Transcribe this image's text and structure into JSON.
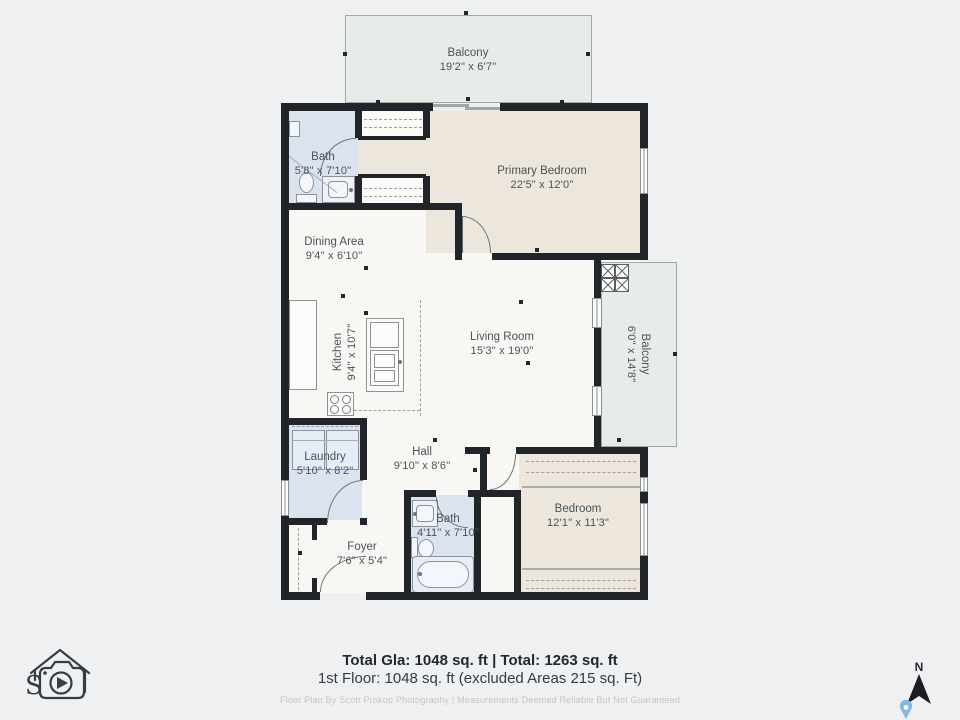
{
  "plan": {
    "rooms": {
      "balcony_top": {
        "name": "Balcony",
        "dims": "19'2\" x 6'7\""
      },
      "bath_upper": {
        "name": "Bath",
        "dims": "5'8\" x 7'10\""
      },
      "primary_bedroom": {
        "name": "Primary Bedroom",
        "dims": "22'5\" x 12'0\""
      },
      "dining": {
        "name": "Dining Area",
        "dims": "9'4\" x 6'10\""
      },
      "kitchen": {
        "name": "Kitchen",
        "dims": "9'4\" x 10'7\""
      },
      "living": {
        "name": "Living Room",
        "dims": "15'3\" x 19'0\""
      },
      "balcony_right": {
        "name": "Balcony",
        "dims": "6'0\" x 14'8\""
      },
      "laundry": {
        "name": "Laundry",
        "dims": "5'10\" x 8'2\""
      },
      "hall": {
        "name": "Hall",
        "dims": "9'10\" x 8'6\""
      },
      "bedroom": {
        "name": "Bedroom",
        "dims": "12'1\" x 11'3\""
      },
      "bath_lower": {
        "name": "Bath",
        "dims": "4'11\" x 7'10\""
      },
      "foyer": {
        "name": "Foyer",
        "dims": "7'6\" x 5'4\""
      }
    },
    "colors": {
      "background": "#eff0f1",
      "floor_white": "#f8f7f3",
      "bedroom_beige": "#ede6dc",
      "bath_blue": "#dbe3ef",
      "balcony_green": "#e7ece8",
      "wall_black": "#212428",
      "label_gray": "#4a525b"
    }
  },
  "footer": {
    "totals": "Total Gla: 1048 sq. ft | Total: 1263 sq. ft",
    "floor_line": "1st Floor: 1048 sq. ft (excluded Areas 215 sq. Ft)",
    "credit": "Floor Plan By Scott Prokop Photography | Measurements Deemed Reliable But Not Guaranteed"
  },
  "compass": {
    "north_label": "N"
  }
}
